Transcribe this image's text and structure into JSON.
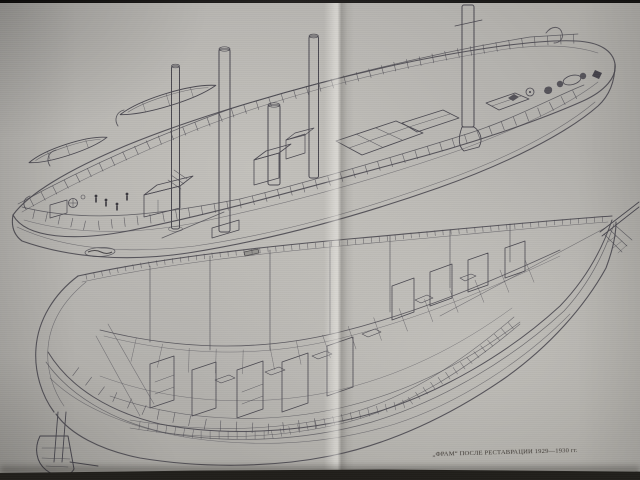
{
  "plate": {
    "caption": "„ФРАМ“ ПОСЛЕ РЕСТАВРАЦИИ 1929—1930 гг.",
    "colors": {
      "paper": "#b4b2ae",
      "paper_light": "#c9c7c2",
      "paper_shadow": "#9c9a95",
      "ink": "#4a4850",
      "ink_dark": "#2e2c30",
      "photo_edge": "#1d1b18"
    }
  }
}
